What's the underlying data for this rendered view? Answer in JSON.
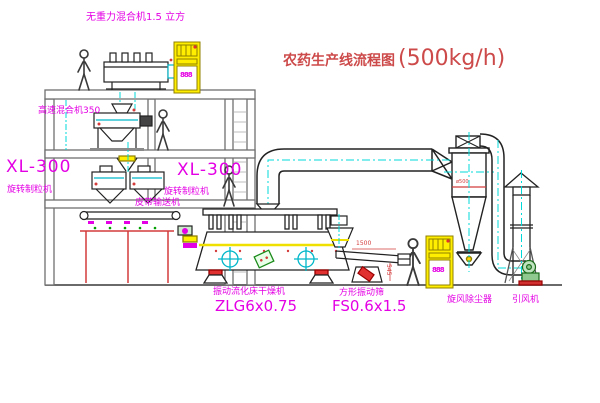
{
  "title": {
    "name": "农药生产线流程图",
    "capacity": "(500kg/h)"
  },
  "labels": {
    "mixer_top": "无重力混合机1.5 立方",
    "mixer_floor2": "高速混合机350",
    "granulator_left_model": "XL-300",
    "granulator_left_name": "旋转制粒机",
    "granulator_right_model": "XL-300",
    "granulator_right_name": "旋转制粒机",
    "belt_conveyor": "皮带输送机",
    "dryer_name": "振动流化床干燥机",
    "dryer_model": "ZLG6x0.75",
    "screen_name": "方形振动筛",
    "screen_model": "FS0.6x1.5",
    "cyclone": "旋风除尘器",
    "fan": "引风机"
  },
  "dimensions": {
    "screen_length": "1500",
    "screen_height": "545",
    "cyclone_diameter": "ø500"
  },
  "control_cabinets": {
    "cabinet_1_display": "888",
    "cabinet_2_display": "888"
  },
  "colors": {
    "structure_gray": "#6f6f6f",
    "equipment_black": "#222222",
    "centerline_cyan": "#00d9d9",
    "label_magenta": "#e400e4",
    "title_red": "#cd4a4a",
    "accent_red": "#d43c3c",
    "cabinet_yellow": "#ffee00",
    "machine_green": "#1a8a1a"
  }
}
